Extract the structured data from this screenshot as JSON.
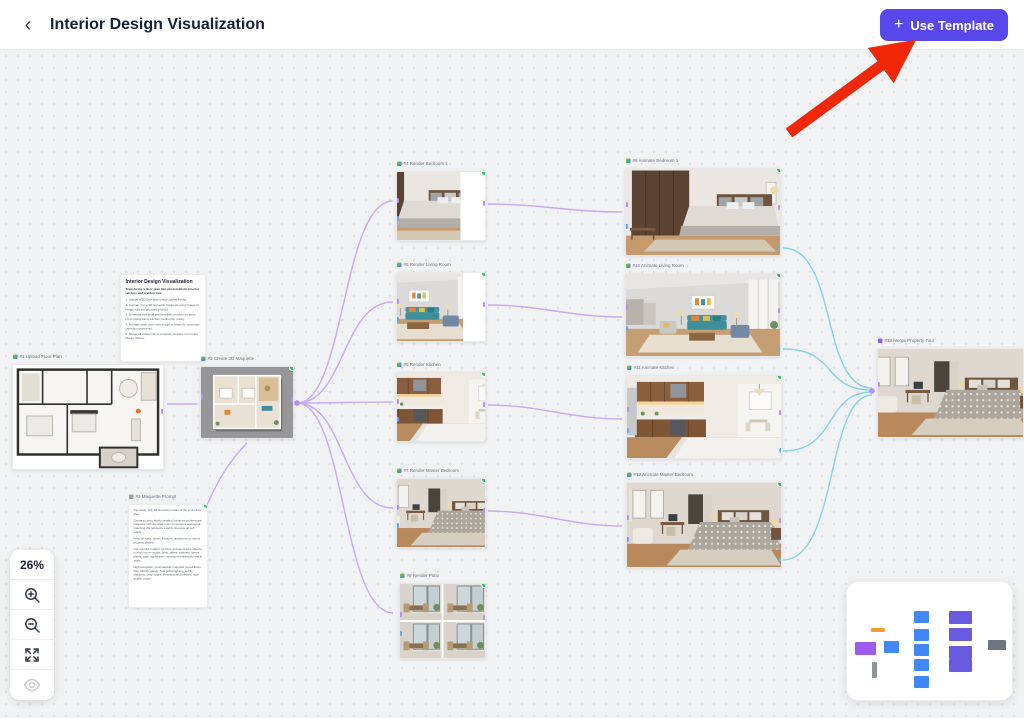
{
  "header": {
    "back_label": "‹",
    "title": "Interior Design Visualization",
    "use_template": {
      "plus": "+",
      "label": "Use Template"
    }
  },
  "colors": {
    "accent_purple": "#5847EB",
    "edge_purple": "#C9ABF2",
    "edge_cyan": "#86D4E6",
    "status_green": "#2EBD6B",
    "arrow_red": "#F02808"
  },
  "nodes": [
    {
      "label": "#1 Upload Floor Plan"
    },
    {
      "label": "#2 Maquette Prompt"
    },
    {
      "label": "#3 Create 3D Maquette"
    },
    {
      "label": "#4 Render Bedroom 1"
    },
    {
      "label": "#5 Render Living Room"
    },
    {
      "label": "#6 Render Kitchen"
    },
    {
      "label": "#7 Render Master Bedroom"
    },
    {
      "label": "#8 Render Patio"
    },
    {
      "label": "#9 Animate Bedroom 1"
    },
    {
      "label": "#10 Animate Living Room"
    },
    {
      "label": "#11 Animate Kitchen"
    },
    {
      "label": "#12 Animate Master Bedroom"
    },
    {
      "label": "#13 Merge Property Tour"
    }
  ],
  "instructions": {
    "title": "Interior Design Visualization",
    "intro": "Transforms a floor plan into photorealistic interior renders and a video tour.",
    "steps": [
      "1. Upload a 2D floor plan using Upload Media.",
      "2. Convert it to a 3D isometric maquette using Image to Image with the provided prompt.",
      "3. Generate eye-level photorealistic renders for each room (living room, kitchen, bedrooms, patio).",
      "4. Animate each room with Image to Video for cinematic camera movements.",
      "5. Merge all videos into a complete property tour using Merge Videos."
    ]
  },
  "prompt_note": {
    "paragraphs": [
      "Top-down, fully 3D isometric render of the entire floor plan.",
      "Create a clean, highly detailed miniature architectural maquette with accurate room proportions and layout, matching the reference exactly. Remove all text labels.",
      "Keep all walls, doors, furniture, appliances or rooms properly placed.",
      "Use colorful, modern furniture and decorative objects in each room—sofas, beds, tables, cabinets, lamps, plants, rugs, appliances—arranged realistically and in scale.",
      "High-resolution, photorealistic materials (wood floors, tiles, fabrics, glass). Soft global lighting, subtle shadows, crisp edges. Professional, polished, high-quality output."
    ]
  },
  "zoom_controls": {
    "zoom_level": "26%",
    "zoom_in_icon": "magnifier-plus",
    "zoom_out_icon": "magnifier-minus",
    "fit_icon": "expand-arrows",
    "visibility_icon": "eye"
  },
  "minimap": {
    "colors": {
      "floor_plan": "#9D5CEB",
      "text_node": "#F0A030",
      "maquette": "#3F88F5",
      "prompt_note": "#8E9499",
      "render_nodes": "#3F88F5",
      "animate_nodes": "#6A5AE0",
      "merge_node": "#6E7681"
    }
  }
}
